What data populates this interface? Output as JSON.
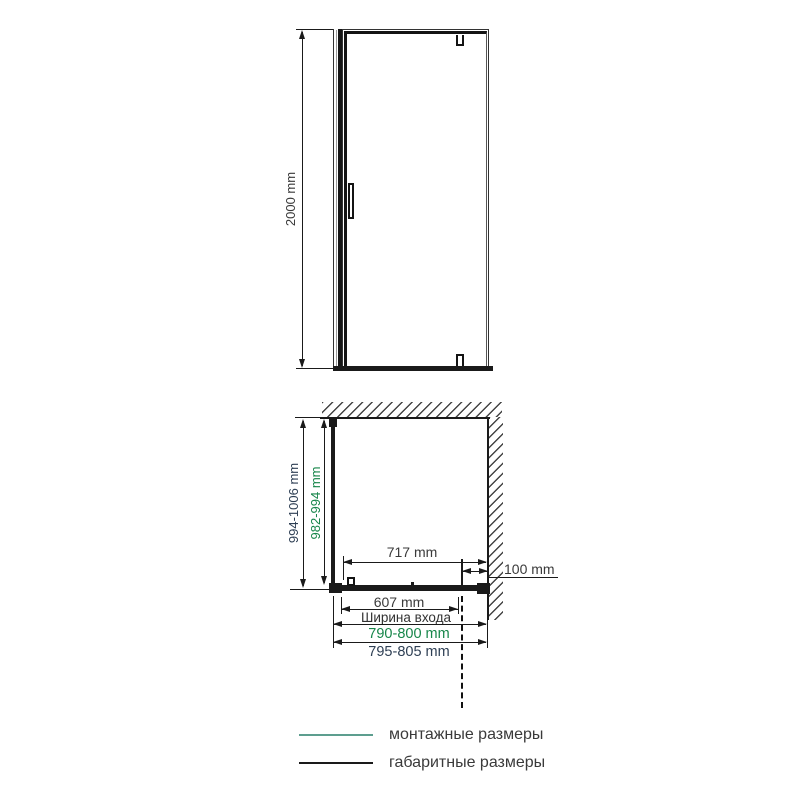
{
  "colors": {
    "drawing_line": "#1a1a1a",
    "dimension_text": "#3a3a3a",
    "mounting_text_green": "#17864a",
    "overall_text_navy": "#2e3f54",
    "legend_mounting_line": "#5d9e8f",
    "legend_overall_line": "#1a1a1a"
  },
  "front_view": {
    "height": "2000 mm"
  },
  "plan_view": {
    "overall_depth": "994-1006 mm",
    "mounting_depth": "982-994 mm",
    "door_glass_width": "717 mm",
    "wall_distance": "100 mm",
    "entrance_width": "607 mm",
    "entrance_caption": "Ширина входа",
    "mounting_width": "790-800 mm",
    "overall_width": "795-805 mm"
  },
  "legend": {
    "items": [
      {
        "label": "монтажные размеры",
        "color": "#5d9e8f"
      },
      {
        "label": "габаритные размеры",
        "color": "#1a1a1a"
      }
    ]
  }
}
